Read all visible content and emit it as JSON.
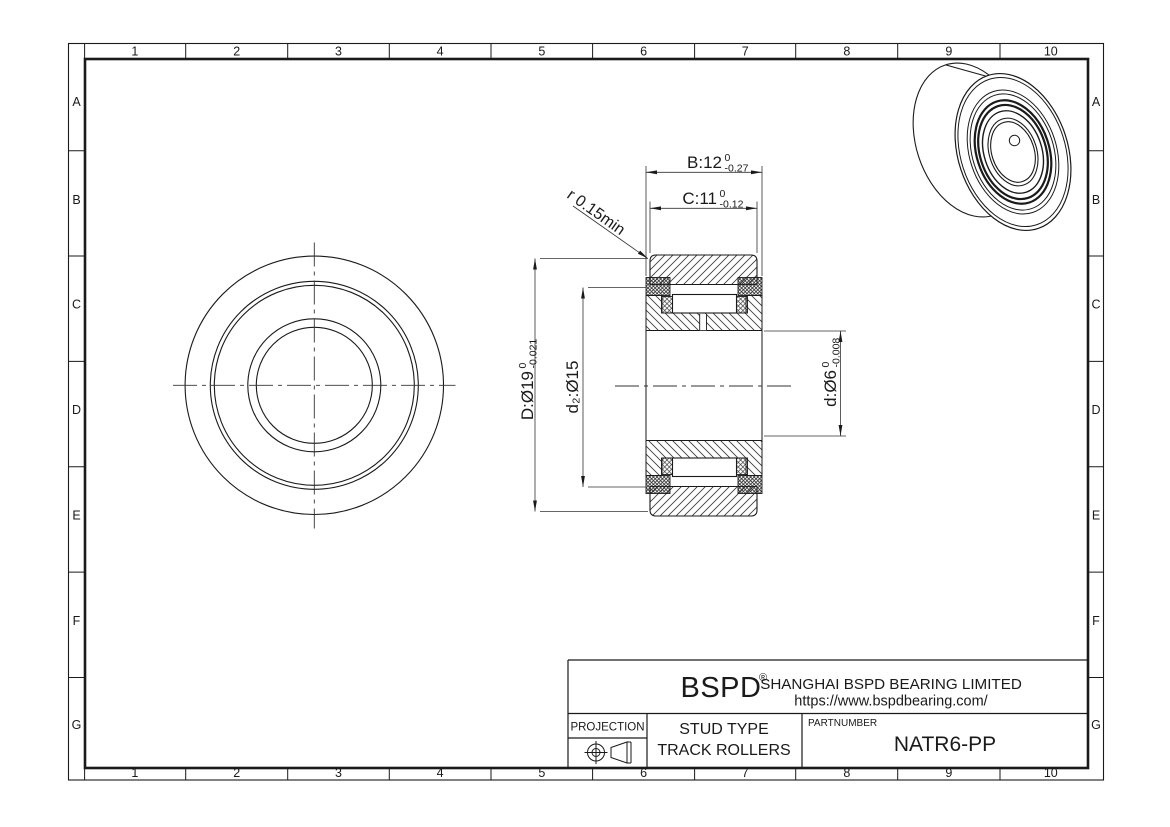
{
  "drawing": {
    "grid": {
      "columns": [
        "1",
        "2",
        "3",
        "4",
        "5",
        "6",
        "7",
        "8",
        "9",
        "10"
      ],
      "rows": [
        "A",
        "B",
        "C",
        "D",
        "E",
        "F",
        "G"
      ]
    },
    "dimensions": {
      "width_b": {
        "text": "B:12",
        "tol_top": "0",
        "tol_bottom": "-0.27"
      },
      "width_c": {
        "text": "C:11",
        "tol_top": "0",
        "tol_bottom": "-0.12"
      },
      "outer_diameter": {
        "text": "D:Ø19",
        "tol_top": "0",
        "tol_bottom": "-0.021"
      },
      "flange_diameter": {
        "text": "d₂:Ø15"
      },
      "bore_diameter": {
        "text": "d:Ø6",
        "tol_top": "0",
        "tol_bottom": "-0.008"
      },
      "fillet_radius": {
        "text": "r 0.15min"
      }
    },
    "title_block": {
      "brand": "BSPD",
      "registered_mark": "®",
      "company": "SHANGHAI BSPD BEARING LIMITED",
      "website": "https://www.bspdbearing.com/",
      "projection_label": "PROJECTION",
      "type_line1": "STUD TYPE",
      "type_line2": "TRACK ROLLERS",
      "partnumber_label": "PARTNUMBER",
      "partnumber": "NATR6-PP"
    },
    "colors": {
      "line": "#1a1a1a",
      "thin_line": "#333333",
      "background": "#ffffff"
    }
  }
}
